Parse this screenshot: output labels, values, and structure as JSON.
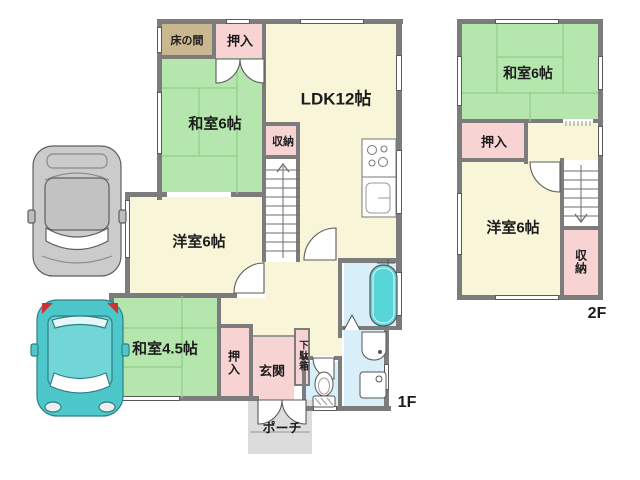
{
  "colors": {
    "wall": "#7c7c7c",
    "green": "#b4e6ae",
    "cream": "#f8f5d8",
    "pink": "#f8d3d3",
    "tan": "#c9b88f",
    "blue": "#d8eef8",
    "tub": "#58d5d8",
    "porch": "#dcdcdc",
    "text": "#1c1c1c"
  },
  "floor1": {
    "floor_label": "1F",
    "rooms": {
      "tokonoma": "床の間",
      "oshiire_top": "押入",
      "washitsu6": "和室6帖",
      "ldk": "LDK12帖",
      "shuno": "収納",
      "yoshitsu6": "洋室6帖",
      "washitsu45": "和室4.5帖",
      "oshiire_bottom": "押入",
      "genkan": "玄関",
      "getabako": "下駄箱",
      "porch": "ポーチ"
    },
    "fixtures": [
      "staircase-up",
      "kitchen-stove",
      "kitchen-sink",
      "bathtub",
      "toilet",
      "washbasin",
      "washing-machine",
      "entrance-double-door",
      "bathroom-folding-door"
    ]
  },
  "floor2": {
    "floor_label": "2F",
    "rooms": {
      "washitsu6": "和室6帖",
      "oshiire": "押入",
      "yoshitsu6": "洋室6帖",
      "shuno": "収納"
    },
    "fixtures": [
      "staircase-down"
    ]
  },
  "parking": {
    "cars": [
      {
        "name": "car-gray",
        "color": "#cbcbcb",
        "roof": "#c2c2c2",
        "stroke": "#5f5f5f"
      },
      {
        "name": "car-teal",
        "color": "#4ec7ca",
        "roof": "#72d5d7",
        "stroke": "#2c7f84"
      }
    ]
  }
}
